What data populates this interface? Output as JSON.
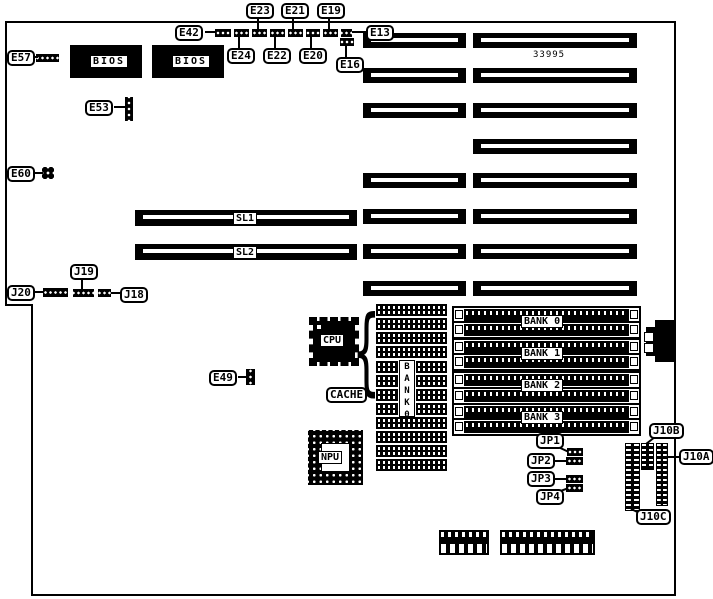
{
  "board": {
    "part_number": "33995",
    "chips": {
      "bios": "BIOS",
      "cpu": "CPU",
      "npu": "NPU",
      "cache": "CACHE"
    },
    "slots": {
      "sl1": "SL1",
      "sl2": "SL2"
    },
    "memory": {
      "banks": [
        "BANK 0",
        "BANK 1",
        "BANK 2",
        "BANK 3"
      ],
      "column_label": "BANK0"
    },
    "callouts": {
      "e13": "E13",
      "e16": "E16",
      "e19": "E19",
      "e20": "E20",
      "e21": "E21",
      "e22": "E22",
      "e23": "E23",
      "e24": "E24",
      "e42": "E42",
      "e49": "E49",
      "e53": "E53",
      "e57": "E57",
      "e60": "E60",
      "j18": "J18",
      "j19": "J19",
      "j20": "J20",
      "jp1": "JP1",
      "jp2": "JP2",
      "jp3": "JP3",
      "jp4": "JP4",
      "j10a": "J10A",
      "j10b": "J10B",
      "j10c": "J10C"
    }
  }
}
